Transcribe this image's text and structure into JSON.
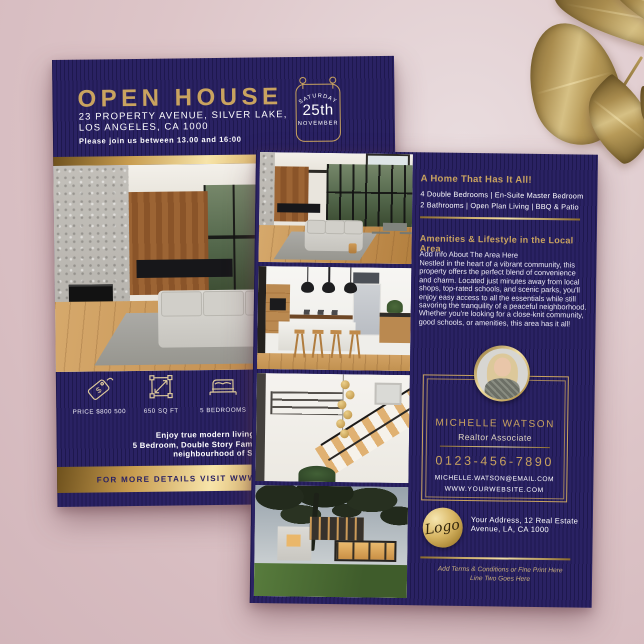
{
  "colors": {
    "background_pink": "#ddc5c8",
    "flyer_navy": "#2a2263",
    "gold": "#c9a35f",
    "gold_bright": "#f7e4a9"
  },
  "back_flyer": {
    "title": "OPEN HOUSE",
    "address_line1": "23 PROPERTY AVENUE, SILVER LAKE,",
    "address_line2": "LOS ANGELES, CA 1000",
    "invite": "Please join us between 13.00 and 16:00",
    "date_badge": {
      "day": "SATURDAY",
      "date": "25th",
      "month": "NOVEMBER"
    },
    "features": [
      {
        "icon": "price-tag-icon",
        "label": "PRICE $800 500"
      },
      {
        "icon": "floor-area-icon",
        "label": "650 SQ FT"
      },
      {
        "icon": "bed-icon",
        "label": "5 BEDROOMS"
      }
    ],
    "description_lines": [
      "Enjoy true modern living in this nov",
      "5 Bedroom, Double Story Family Home. Conven",
      "neighbourhood of Silver La"
    ],
    "footer": "FOR MORE DETAILS VISIT WWW.YOURWEBSITE.COM"
  },
  "front_flyer": {
    "headline": "A Home That Has It All!",
    "features_line1": "4 Double Bedrooms | En-Suite Master Bedroom",
    "features_line2": "2 Bathrooms | Open Plan Living | BBQ & Patio",
    "amenities_heading": "Amenities & Lifestyle in the Local Area",
    "amenities_sub": "Add Info About The Area Here",
    "amenities_body": "Nestled in the heart of a vibrant community, this property offers the perfect blend of convenience and charm. Located just minutes away from local shops, top-rated schools, and scenic parks, you'll enjoy easy access to all the essentials while still savoring the tranquility of a peaceful neighborhood. Whether you're looking for a close-knit community, good schools, or amenities, this area has it all!",
    "agent": {
      "name": "MICHELLE WATSON",
      "title": "Realtor Associate",
      "phone": "0123-456-7890",
      "email": "MICHELLE.WATSON@EMAIL.COM",
      "website": "WWW.YOURWEBSITE.COM"
    },
    "logo_text": "Logo",
    "company_address_line1": "Your Address, 12 Real Estate",
    "company_address_line2": "Avenue, LA, CA 1000",
    "terms_line1": "Add Terms & Conditions or Fine Print Here",
    "terms_line2": "Line Two Goes Here"
  }
}
